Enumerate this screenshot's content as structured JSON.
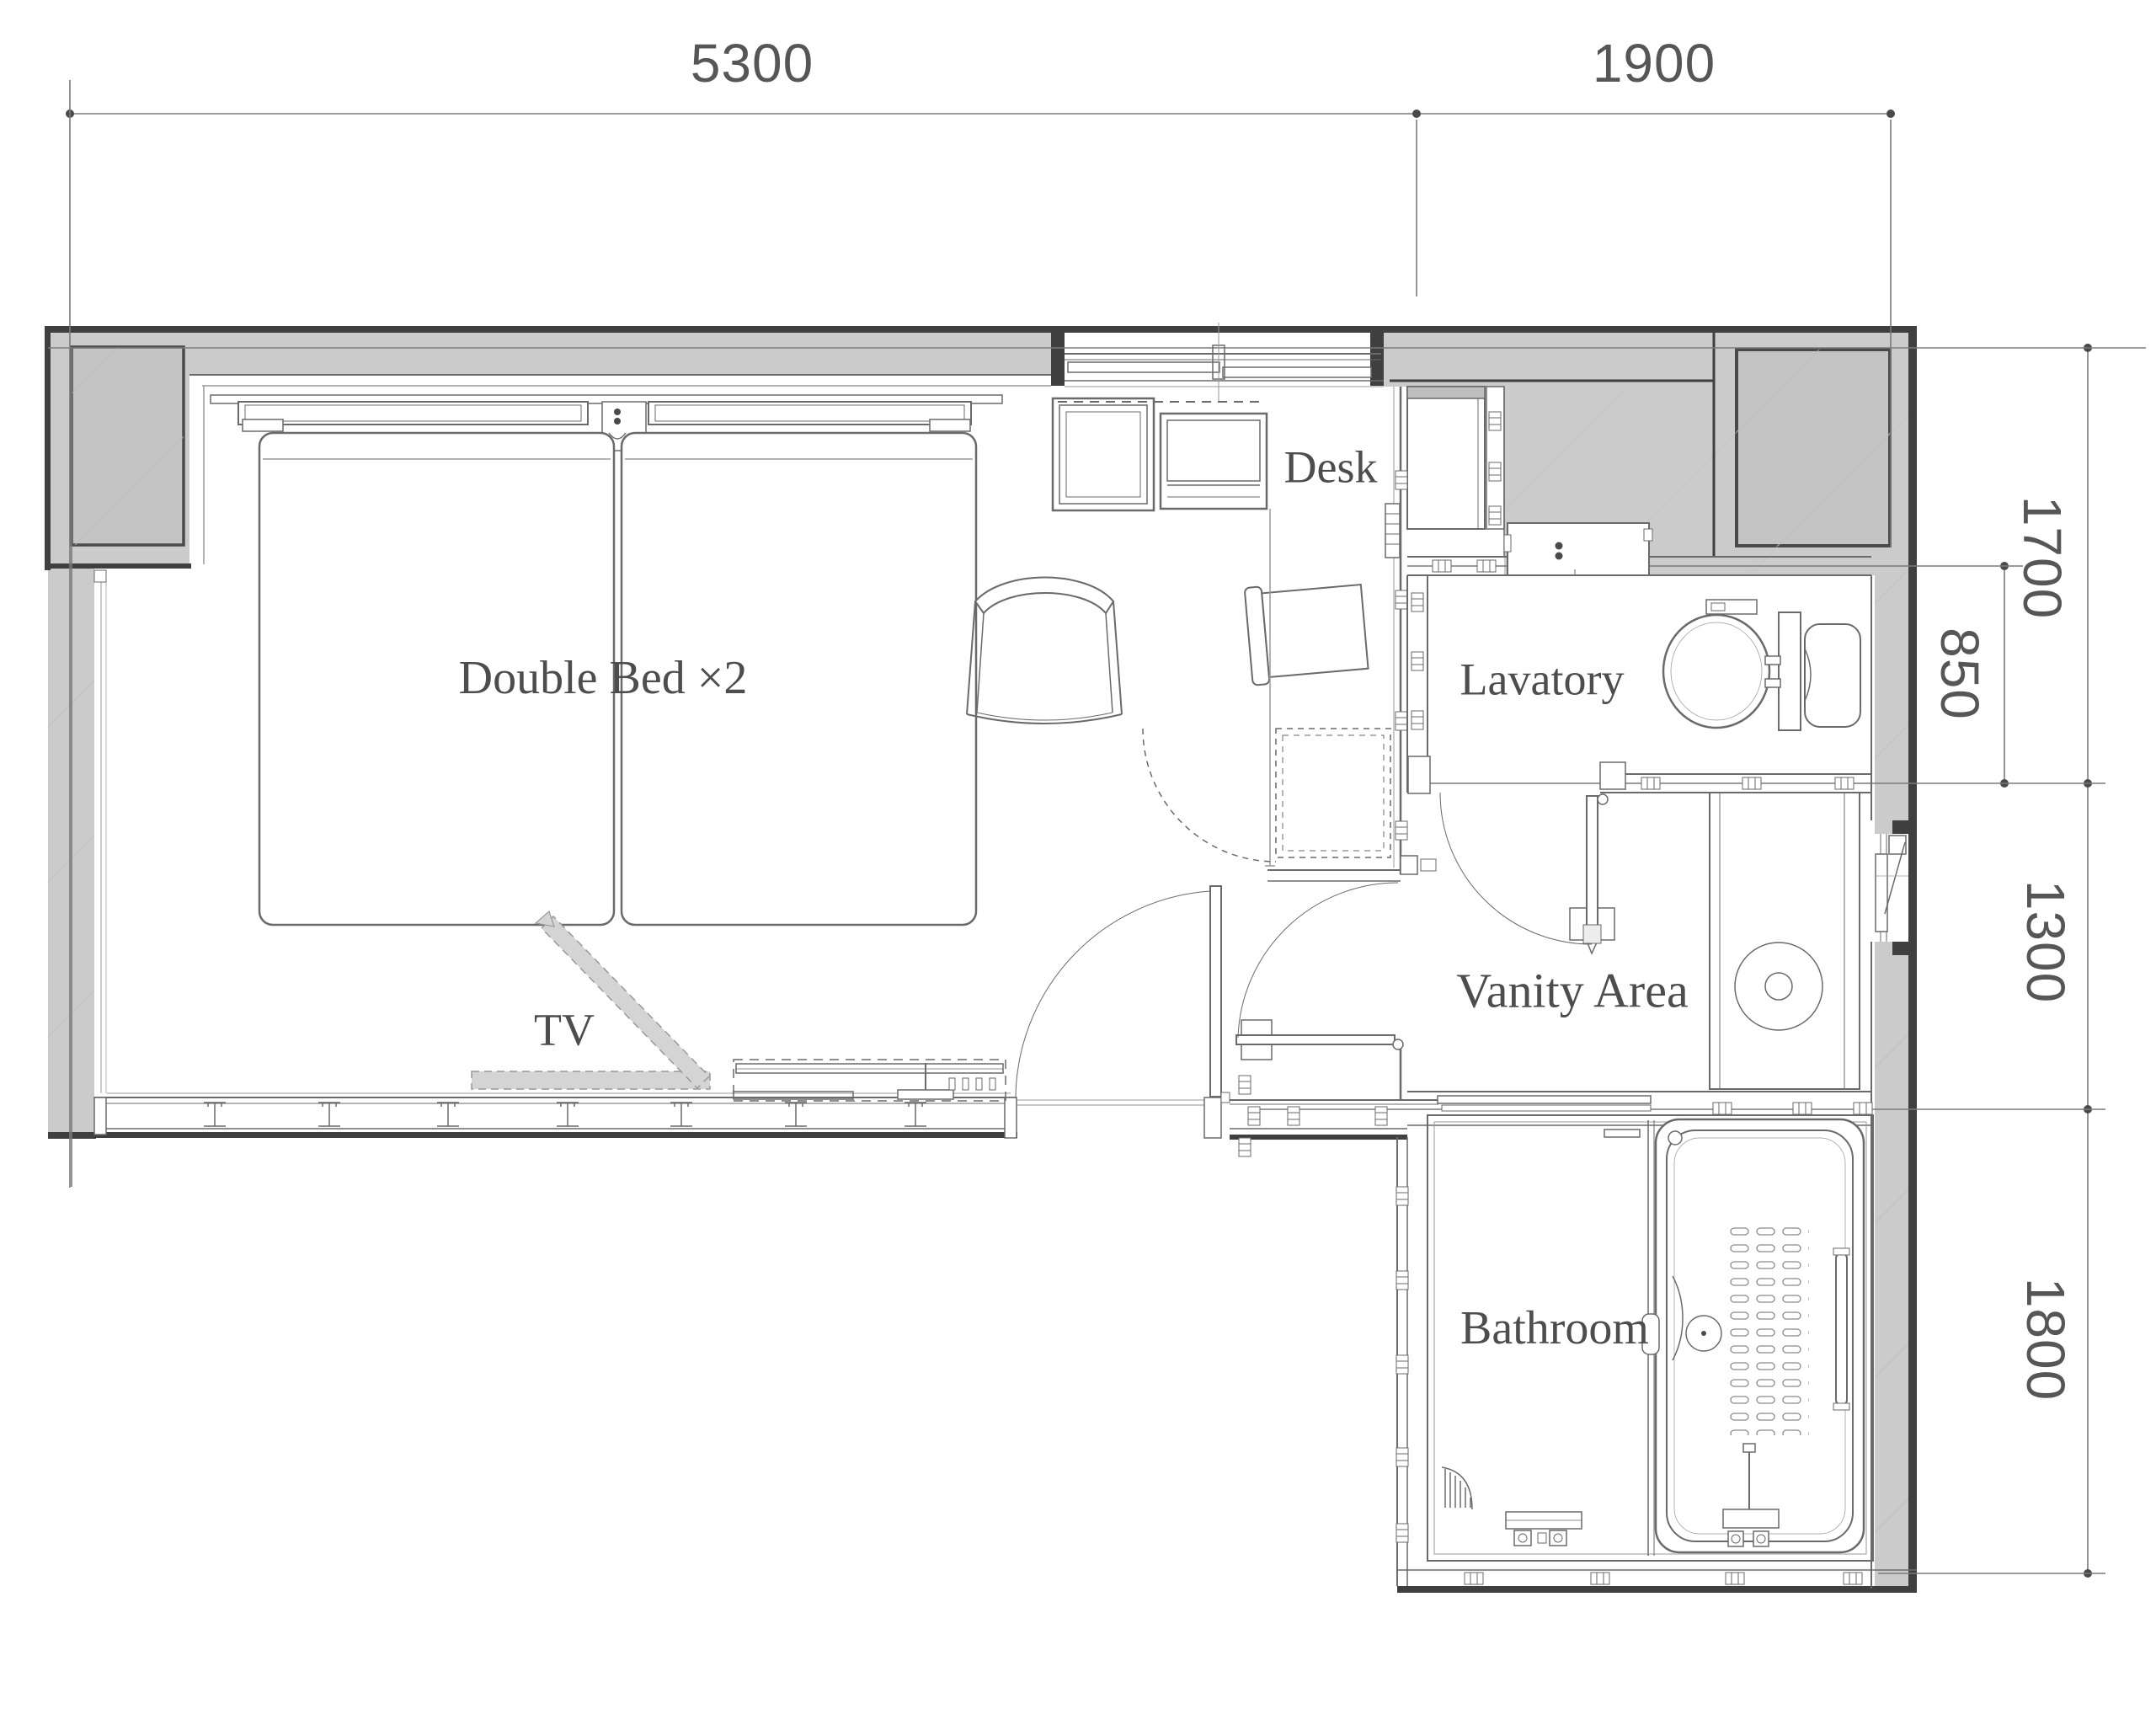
{
  "plan": {
    "rooms": [
      {
        "id": "double-bed",
        "label": "Double Bed ×2"
      },
      {
        "id": "tv",
        "label": "TV"
      },
      {
        "id": "desk",
        "label": "Desk"
      },
      {
        "id": "lavatory",
        "label": "Lavatory"
      },
      {
        "id": "vanity",
        "label": "Vanity Area"
      },
      {
        "id": "bathroom",
        "label": "Bathroom"
      }
    ],
    "dimensions_mm": {
      "top": [
        {
          "label": "5300"
        },
        {
          "label": "1900"
        }
      ],
      "right": [
        {
          "label": "1700"
        },
        {
          "label": "850"
        },
        {
          "label": "1300"
        },
        {
          "label": "1800"
        }
      ]
    },
    "colors": {
      "wall_fill": "#cbcbcb",
      "wall_inner_fill": "#c4c4c4",
      "wall_dark_edge": "#3f3f3f",
      "drawing_line": "#6a6a6a",
      "room_label_text": "#4d4d4d",
      "dimension_text": "#565656",
      "tv_band_fill": "#d4d4d4",
      "background": "#ffffff"
    }
  }
}
